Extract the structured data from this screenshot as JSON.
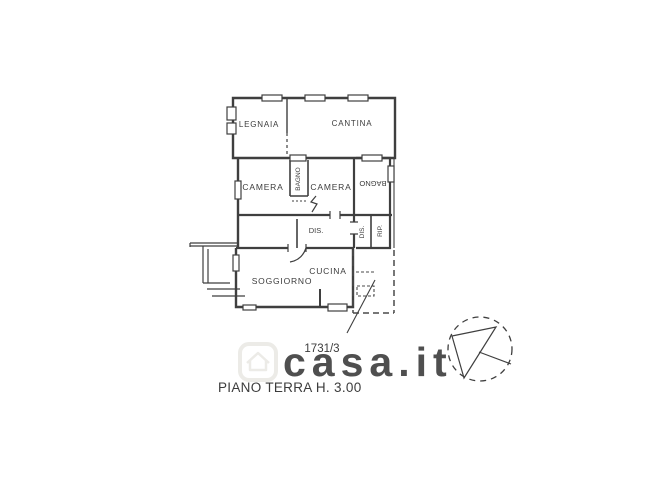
{
  "plan": {
    "rooms": {
      "legnaia": "LEGNAIA",
      "cantina": "CANTINA",
      "camera_left": "CAMERA",
      "bagno_middle": "BAGNO",
      "camera_right": "CAMERA",
      "bagno_right": "BAGNO",
      "dis_main": "DIS.",
      "dis_wing": "DIS.",
      "rip": "RIP.",
      "soggiorno": "SOGGIORNO",
      "cucina": "CUCINA"
    },
    "parcel_number": "1731/3",
    "caption": "PIANO TERRA H. 3.00"
  },
  "watermark": {
    "text": "casa.it",
    "icon": "house-logo"
  },
  "icons": {
    "compass": "north-arrow"
  },
  "colors": {
    "background": "#ffffff",
    "line": "#3f3f3f",
    "text": "#3c3c3c",
    "watermark": "#eae9e5"
  }
}
